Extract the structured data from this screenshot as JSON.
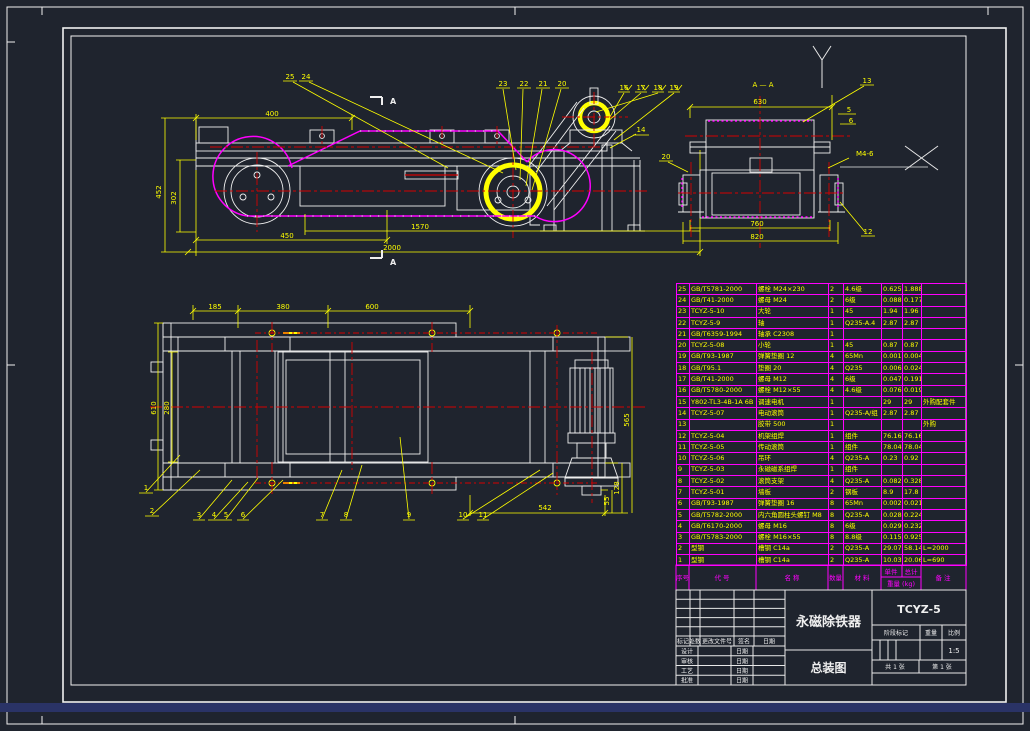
{
  "colors": {
    "background": "#1f242e",
    "line_white": "#f0f0f0",
    "dim_yellow": "#ffff00",
    "grid_magenta": "#ff00ff",
    "center_red": "#d40000",
    "bottom_bar_blue": "#2a3366"
  },
  "views": {
    "side": {
      "dims": {
        "top": "400",
        "left_outer": "452",
        "left_inner": "302",
        "bottom_1": "450",
        "bottom_2": "1570",
        "bottom_3": "2000"
      },
      "leaders": [
        "25",
        "24",
        "23",
        "22",
        "21",
        "20",
        "16",
        "17",
        "18",
        "19",
        "14"
      ],
      "section_mark_top": "A",
      "section_mark_bottom": "A"
    },
    "section": {
      "title": "A — A",
      "dims": {
        "top": "630",
        "right_1": "5",
        "right_2": "6",
        "bottom_1": "760",
        "bottom_2": "820"
      },
      "leaders": {
        "l13": "13",
        "l20": "20",
        "l12": "12"
      },
      "thread_note": "M4-6"
    },
    "plan": {
      "dims": {
        "t1": "185",
        "t2": "380",
        "t3": "600",
        "l1": "610",
        "l2": "280",
        "r1": "565",
        "r2": "128",
        "r3": "55",
        "b1": "542"
      },
      "leaders": [
        "1",
        "2",
        "3",
        "4",
        "5",
        "6",
        "7",
        "8",
        "9",
        "10",
        "11"
      ]
    }
  },
  "bom": {
    "headers": {
      "no": "序号",
      "code": "代 号",
      "name": "名 称",
      "qty": "数量",
      "material": "材 料",
      "unit": "单件",
      "total": "总计",
      "weight": "重量 (kg)",
      "remark": "备 注"
    },
    "rows": [
      {
        "no": "25",
        "code": "GB/T5781-2000",
        "name": "螺栓 M24×230",
        "qty": "2",
        "material": "4.6级",
        "unit": "0.625",
        "total": "1.888",
        "remark": ""
      },
      {
        "no": "24",
        "code": "GB/T41-2000",
        "name": "螺母 M24",
        "qty": "2",
        "material": "6级",
        "unit": "0.0888",
        "total": "0.1776",
        "remark": ""
      },
      {
        "no": "23",
        "code": "TCYZ-5-10",
        "name": "大轮",
        "qty": "1",
        "material": "45",
        "unit": "1.94",
        "total": "1.96",
        "remark": ""
      },
      {
        "no": "22",
        "code": "TCYZ-5-9",
        "name": "轴",
        "qty": "1",
        "material": "Q235-A.4",
        "unit": "2.87",
        "total": "2.87",
        "remark": ""
      },
      {
        "no": "21",
        "code": "GB/T6359-1994",
        "name": "轴承 C2308",
        "qty": "1",
        "material": "",
        "unit": "",
        "total": "",
        "remark": ""
      },
      {
        "no": "20",
        "code": "TCYZ-5-08",
        "name": "小轮",
        "qty": "1",
        "material": "45",
        "unit": "0.87",
        "total": "0.87",
        "remark": ""
      },
      {
        "no": "19",
        "code": "GB/T93-1987",
        "name": "弹簧垫圈 12",
        "qty": "4",
        "material": "65Mn",
        "unit": "0.00111",
        "total": "0.0045",
        "remark": ""
      },
      {
        "no": "18",
        "code": "GB/T95.1",
        "name": "垫圈 20",
        "qty": "4",
        "material": "Q235",
        "unit": "0.006",
        "total": "0.024",
        "remark": ""
      },
      {
        "no": "17",
        "code": "GB/T41-2000",
        "name": "螺母 M12",
        "qty": "4",
        "material": "6级",
        "unit": "0.0477",
        "total": "0.191",
        "remark": ""
      },
      {
        "no": "16",
        "code": "GB/T5780-2000",
        "name": "螺栓 M12×55",
        "qty": "4",
        "material": "4.6级",
        "unit": "0.076",
        "total": "0.019",
        "remark": ""
      },
      {
        "no": "15",
        "code": "Y802-TL3-4B-1A 6B",
        "name": "调速电机",
        "qty": "1",
        "material": "",
        "unit": "29",
        "total": "29",
        "remark": "外购配套件"
      },
      {
        "no": "14",
        "code": "TCYZ-5-07",
        "name": "电动滚筒",
        "qty": "1",
        "material": "Q235-A/组",
        "unit": "2.87",
        "total": "2.87",
        "remark": ""
      },
      {
        "no": "13",
        "code": "",
        "name": "胶带 500",
        "qty": "1",
        "material": "",
        "unit": "",
        "total": "",
        "remark": "外购"
      },
      {
        "no": "12",
        "code": "TCYZ-5-04",
        "name": "机架组焊",
        "qty": "1",
        "material": "组件",
        "unit": "76.168",
        "total": "76.168",
        "remark": ""
      },
      {
        "no": "11",
        "code": "TCYZ-5-05",
        "name": "传动滚筒",
        "qty": "1",
        "material": "组件",
        "unit": "78.045",
        "total": "78.045",
        "remark": ""
      },
      {
        "no": "10",
        "code": "TCYZ-5-06",
        "name": "吊环",
        "qty": "4",
        "material": "Q235-A",
        "unit": "0.23",
        "total": "0.92",
        "remark": ""
      },
      {
        "no": "9",
        "code": "TCYZ-5-03",
        "name": "永磁磁系组焊",
        "qty": "1",
        "material": "组件",
        "unit": "",
        "total": "",
        "remark": ""
      },
      {
        "no": "8",
        "code": "TCYZ-5-02",
        "name": "滚筒支架",
        "qty": "4",
        "material": "Q235-A",
        "unit": "0.082",
        "total": "0.328",
        "remark": ""
      },
      {
        "no": "7",
        "code": "TCYZ-5-01",
        "name": "墙板",
        "qty": "2",
        "material": "钢板",
        "unit": "8.9",
        "total": "17.8",
        "remark": ""
      },
      {
        "no": "6",
        "code": "GB/T93-1987",
        "name": "弹簧垫圈 16",
        "qty": "8",
        "material": "65Mn",
        "unit": "0.00268",
        "total": "0.02144",
        "remark": ""
      },
      {
        "no": "5",
        "code": "GB/T5782-2000",
        "name": "内六角圆柱头螺钉 M8",
        "qty": "8",
        "material": "Q235-A",
        "unit": "0.028",
        "total": "0.224",
        "remark": ""
      },
      {
        "no": "4",
        "code": "GB/T6170-2000",
        "name": "螺母 M16",
        "qty": "8",
        "material": "6级",
        "unit": "0.029",
        "total": "0.232",
        "remark": ""
      },
      {
        "no": "3",
        "code": "GB/T5783-2000",
        "name": "螺栓 M16×55",
        "qty": "8",
        "material": "8.8级",
        "unit": "0.1157",
        "total": "0.9256",
        "remark": ""
      },
      {
        "no": "2",
        "code": "型钢",
        "name": "槽钢 C14a",
        "qty": "2",
        "material": "Q235-A",
        "unit": "29.07",
        "total": "58.14",
        "remark": "L=2000"
      },
      {
        "no": "1",
        "code": "型钢",
        "name": "槽钢 C14a",
        "qty": "2",
        "material": "Q235-A",
        "unit": "10.03",
        "total": "20.06",
        "remark": "L=690"
      }
    ]
  },
  "title_block": {
    "product_name": "永磁除铁器",
    "drawing_name": "总装图",
    "model": "TCYZ-5",
    "stage_label": "阶段标记",
    "weight_label": "重量",
    "scale_label": "比例",
    "scale_value": "1:5",
    "sheet_total": "共 1 张",
    "sheet_no": "第 1 张",
    "rev_headers": [
      "标记",
      "处数",
      "更改文件号",
      "签名",
      "日期"
    ],
    "sign_rows": [
      {
        "role": "设计",
        "date_label": "日期"
      },
      {
        "role": "审核",
        "date_label": "日期"
      },
      {
        "role": "工艺",
        "date_label": "日期"
      },
      {
        "role": "批准",
        "date_label": "日期"
      }
    ]
  }
}
